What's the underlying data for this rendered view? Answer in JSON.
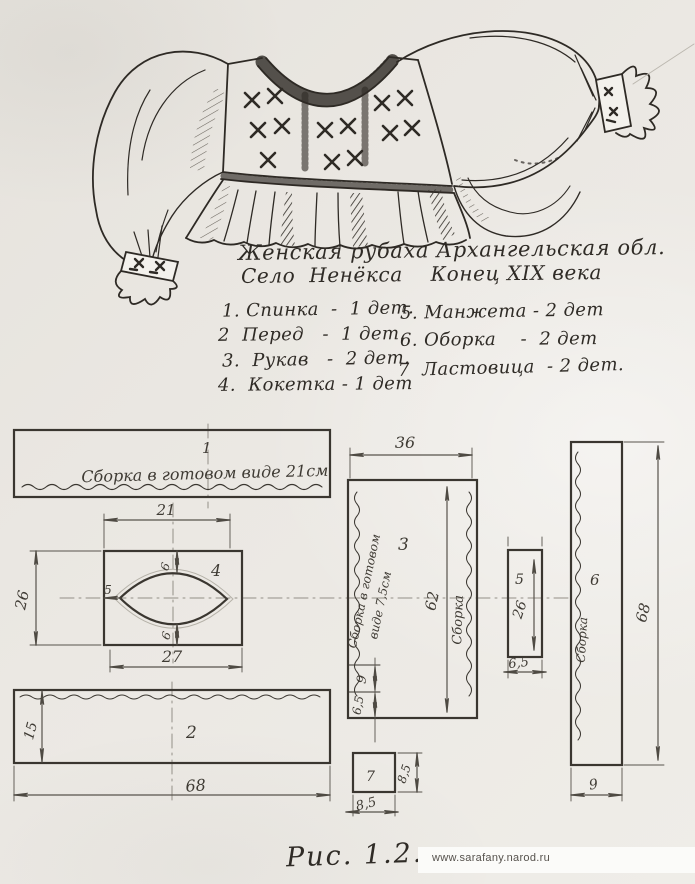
{
  "title": {
    "line1": "Женская рубаха Архангельская обл.",
    "line2": "Село  Ненёкса    Конец XIX века"
  },
  "parts_list": {
    "left": [
      "1. Спинка  -  1 дет.",
      "2  Перед   -  1 дет.",
      "3.  Рукав   -  2 дет.",
      "4.  Кокетка - 1 дет"
    ],
    "right": [
      "5. Манжета - 2 дет",
      "6. Оборка    -  2 дет",
      "7  Ластовица  - 2 дет."
    ]
  },
  "pieces": {
    "p1": {
      "label": "1",
      "note": "Сборка  в готовом виде 21см"
    },
    "p2": {
      "label": "2",
      "height": "15",
      "width": "68"
    },
    "p3": {
      "label": "3",
      "top": "36",
      "length": "62",
      "note1": "Сборка в готовом",
      "note2": "виде 7,5см",
      "gather": "Сборка",
      "dim9": "9",
      "dim65": "6,5"
    },
    "p4": {
      "label": "4",
      "top": "21",
      "bottom": "27",
      "side": "26",
      "gap_top": "6",
      "gap_bottom": "6",
      "inset": "5"
    },
    "p5": {
      "label": "5",
      "length": "26",
      "width": "6,5"
    },
    "p6": {
      "label": "6",
      "height": "68",
      "width": "9",
      "gather": "Сборка"
    },
    "p7": {
      "label": "7",
      "side": "8,5",
      "bottom": "8,5"
    }
  },
  "caption": "Рис. 1.2.",
  "watermark": "www.sarafany.narod.ru",
  "colors": {
    "paper": "#ebe8e3",
    "ink": "#2f2b26",
    "dimension_line": "#56524c",
    "construction_line": "#928e86",
    "watermark_text": "#56524d"
  }
}
